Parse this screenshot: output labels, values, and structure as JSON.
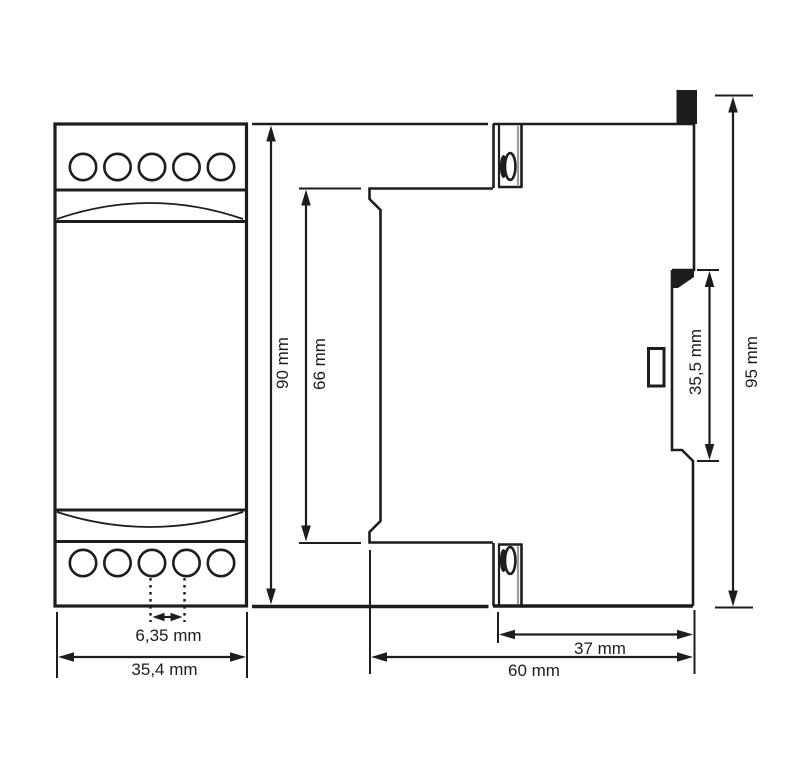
{
  "drawing": {
    "views": {
      "front": {
        "width_label": "35,4 mm",
        "terminal_pitch_label": "6,35 mm",
        "height_label": "90 mm",
        "body_height_label": "66 mm"
      },
      "side": {
        "total_height_label": "95 mm",
        "rail_recess_label": "35,5 mm",
        "rear_depth_label": "37 mm",
        "total_depth_label": "60 mm"
      }
    },
    "colors": {
      "line": "#1d1d1b",
      "secondary_line": "#9c9c9c",
      "background": "#ffffff"
    }
  }
}
